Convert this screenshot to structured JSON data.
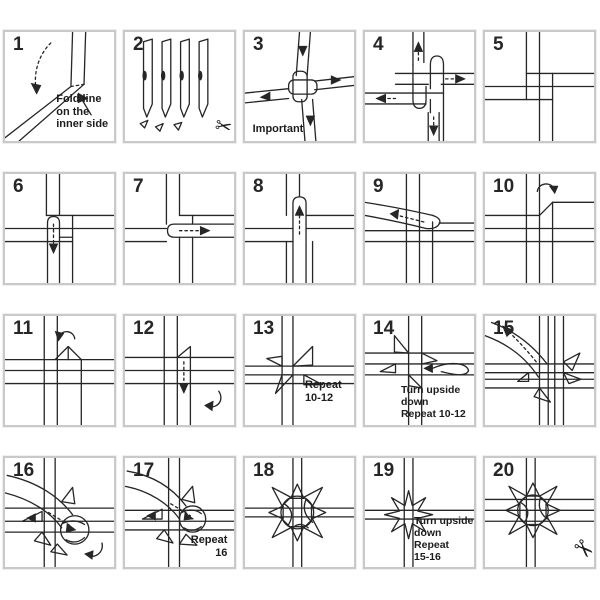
{
  "colors": {
    "line": "#262626",
    "panel_border": "#c9c9c9",
    "background": "#ffffff"
  },
  "icons": {
    "scissors": "✂"
  },
  "panels": [
    {
      "number": "1",
      "caption": "Fold line\non the\ninner side"
    },
    {
      "number": "2",
      "caption": ""
    },
    {
      "number": "3",
      "caption": "Important"
    },
    {
      "number": "4",
      "caption": ""
    },
    {
      "number": "5",
      "caption": ""
    },
    {
      "number": "6",
      "caption": ""
    },
    {
      "number": "7",
      "caption": ""
    },
    {
      "number": "8",
      "caption": ""
    },
    {
      "number": "9",
      "caption": ""
    },
    {
      "number": "10",
      "caption": ""
    },
    {
      "number": "11",
      "caption": ""
    },
    {
      "number": "12",
      "caption": ""
    },
    {
      "number": "13",
      "caption": "Repeat\n10-12"
    },
    {
      "number": "14",
      "caption": "Turn upside\ndown\nRepeat 10-12"
    },
    {
      "number": "15",
      "caption": ""
    },
    {
      "number": "16",
      "caption": ""
    },
    {
      "number": "17",
      "caption": "Repeat\n16"
    },
    {
      "number": "18",
      "caption": ""
    },
    {
      "number": "19",
      "caption": "Turn upside\ndown\nRepeat\n15-16"
    },
    {
      "number": "20",
      "caption": ""
    }
  ]
}
